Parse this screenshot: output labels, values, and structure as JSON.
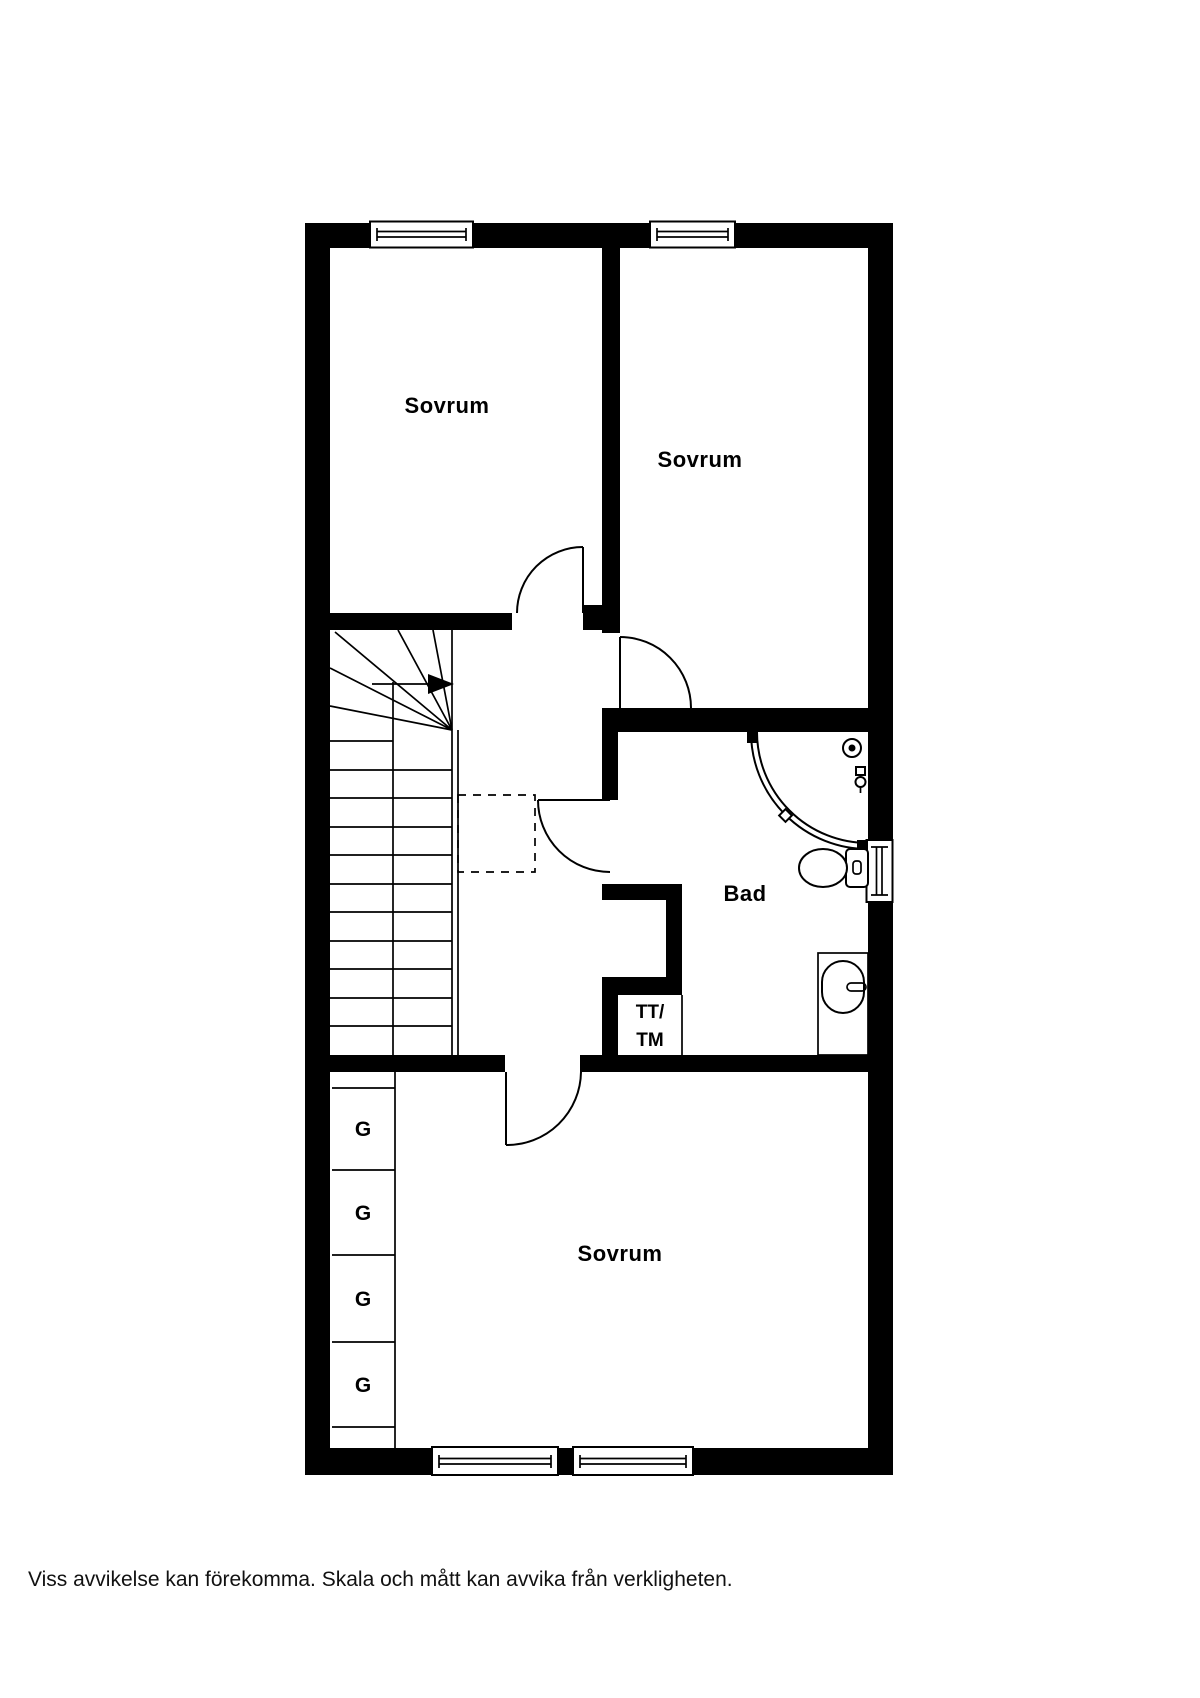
{
  "colors": {
    "wall": "#000000",
    "background": "#ffffff",
    "line": "#000000"
  },
  "floorplan": {
    "rooms": {
      "bedroom_top_left": {
        "label": "Sovrum"
      },
      "bedroom_top_right": {
        "label": "Sovrum"
      },
      "bathroom": {
        "label": "Bad"
      },
      "bedroom_bottom": {
        "label": "Sovrum"
      },
      "laundry_niche": {
        "label_line1": "TT/",
        "label_line2": "TM"
      },
      "wardrobes": {
        "label": "G",
        "count": 4
      }
    }
  },
  "footer": {
    "disclaimer": "Viss avvikelse kan förekomma. Skala och mått kan avvika från verkligheten."
  }
}
